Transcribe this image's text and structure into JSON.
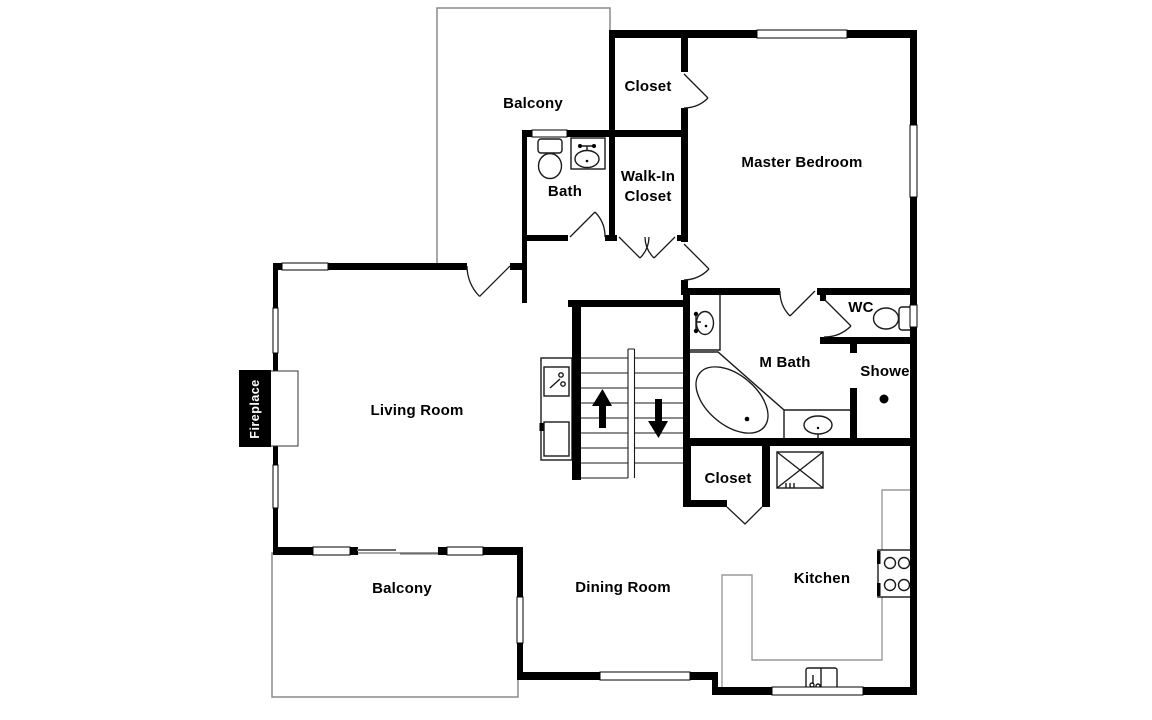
{
  "floorplan": {
    "background_color": "#ffffff",
    "wall_color": "#000000",
    "thin_line_color": "#8a8a8a",
    "rooms": {
      "balcony_top": "Balcony",
      "closet_top": "Closet",
      "master_bedroom": "Master Bedroom",
      "bath": "Bath",
      "walk_in_closet": [
        "Walk-In",
        "Closet"
      ],
      "living_room": "Living Room",
      "fireplace": "Fireplace",
      "m_bath": "M Bath",
      "wc": "WC",
      "shower": "Shower",
      "closet_middle": "Closet",
      "kitchen": "Kitchen",
      "dining_room": "Dining Room",
      "balcony_bottom": "Balcony"
    },
    "icons": {
      "stairs_up_arrow": "▲",
      "stairs_down_arrow": "▼"
    }
  }
}
